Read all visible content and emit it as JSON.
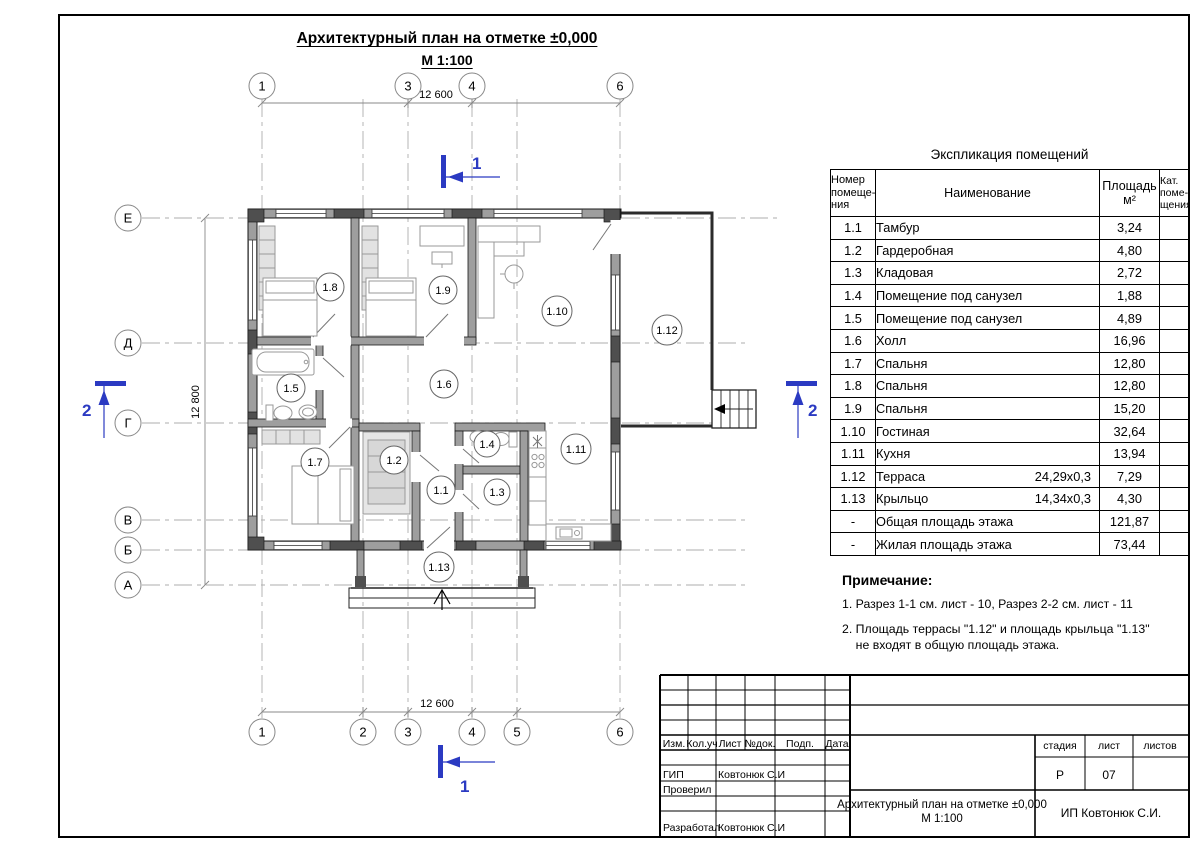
{
  "drawing": {
    "title": "Архитектурный план на отметке ±0,000",
    "scale": "М 1:100"
  },
  "plan": {
    "room_labels": [
      "1.8",
      "1.9",
      "1.10",
      "1.12",
      "1.5",
      "1.6",
      "1.7",
      "1.2",
      "1.1",
      "1.4",
      "1.3",
      "1.11",
      "1.13"
    ],
    "axes_top": [
      "1",
      "3",
      "4",
      "6"
    ],
    "axes_bottom": [
      "1",
      "2",
      "3",
      "4",
      "5",
      "6"
    ],
    "axes_left": [
      "Е",
      "Д",
      "Г",
      "В",
      "Б",
      "А"
    ],
    "dims": {
      "top": "12 600",
      "bottom": "12 600",
      "left": "12 800"
    },
    "sections": {
      "cut1": "1",
      "cut2": "2"
    },
    "colors": {
      "section_marker_blue": "#2b3ac2",
      "wall_gray": "#9e9e9e",
      "pier_dark": "#4f4f4f"
    }
  },
  "spec_table": {
    "title": "Экспликация помещений",
    "headers": {
      "num": "Номер\nпомеще-\nния",
      "name": "Наименование",
      "area": "Площадь\nм²",
      "cat": "Кат.\nпоме-\nщения"
    },
    "rows": [
      {
        "num": "1.1",
        "name": "Тамбур",
        "dim": "",
        "area": "3,24",
        "cat": ""
      },
      {
        "num": "1.2",
        "name": "Гардеробная",
        "dim": "",
        "area": "4,80",
        "cat": ""
      },
      {
        "num": "1.3",
        "name": "Кладовая",
        "dim": "",
        "area": "2,72",
        "cat": ""
      },
      {
        "num": "1.4",
        "name": "Помещение под санузел",
        "dim": "",
        "area": "1,88",
        "cat": ""
      },
      {
        "num": "1.5",
        "name": "Помещение под санузел",
        "dim": "",
        "area": "4,89",
        "cat": ""
      },
      {
        "num": "1.6",
        "name": "Холл",
        "dim": "",
        "area": "16,96",
        "cat": ""
      },
      {
        "num": "1.7",
        "name": "Спальня",
        "dim": "",
        "area": "12,80",
        "cat": ""
      },
      {
        "num": "1.8",
        "name": "Спальня",
        "dim": "",
        "area": "12,80",
        "cat": ""
      },
      {
        "num": "1.9",
        "name": "Спальня",
        "dim": "",
        "area": "15,20",
        "cat": ""
      },
      {
        "num": "1.10",
        "name": "Гостиная",
        "dim": "",
        "area": "32,64",
        "cat": ""
      },
      {
        "num": "1.11",
        "name": "Кухня",
        "dim": "",
        "area": "13,94",
        "cat": ""
      },
      {
        "num": "1.12",
        "name": "Терраса",
        "dim": "24,29x0,3",
        "area": "7,29",
        "cat": ""
      },
      {
        "num": "1.13",
        "name": "Крыльцо",
        "dim": "14,34x0,3",
        "area": "4,30",
        "cat": ""
      },
      {
        "num": "-",
        "name": "Общая площадь этажа",
        "dim": "",
        "area": "121,87",
        "cat": ""
      },
      {
        "num": "-",
        "name": "Жилая площадь этажа",
        "dim": "",
        "area": "73,44",
        "cat": ""
      }
    ]
  },
  "notes": {
    "heading": "Примечание:",
    "items": [
      {
        "text": "1. Разрез 1-1 см. лист - 10, Разрез 2-2 см. лист - 11"
      },
      {
        "text": "2. Площадь террасы \"1.12\" и площадь крыльца \"1.13\"\n    не входят в общую площадь этажа."
      }
    ]
  },
  "stamp": {
    "rev_cols": [
      "Изм.",
      "Кол.уч",
      "Лист",
      "№док.",
      "Подп.",
      "Дата"
    ],
    "sign_rows": [
      {
        "role": "ГИП",
        "name": "Ковтонюк С.И"
      },
      {
        "role": "Проверил",
        "name": ""
      },
      {
        "role": "Разработал",
        "name": "Ковтонюк С.И"
      }
    ],
    "stage_label": "стадия",
    "sheet_label": "лист",
    "sheets_label": "листов",
    "stage": "Р",
    "sheet_no": "07",
    "sheets_total": "",
    "doc_title": "Архитектурный план на отметке ±0,000",
    "doc_scale": "М 1:100",
    "company": "ИП Ковтонюк С.И."
  }
}
